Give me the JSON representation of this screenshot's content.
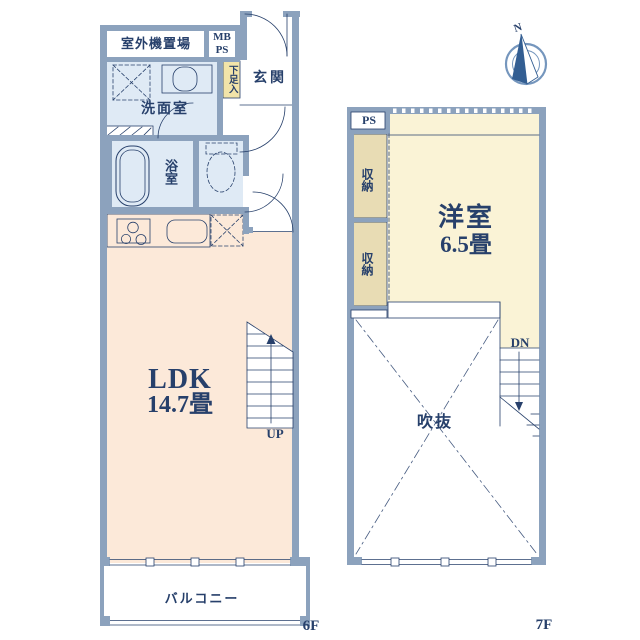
{
  "plan": {
    "floor_6f": {
      "floor_label": "6F",
      "outdoor_unit": "室外機置場",
      "meter_box": "MB",
      "pipe_shaft": "PS",
      "entrance": "玄関",
      "shoe_cabinet": "下足入",
      "washroom": "洗面室",
      "bathroom": "浴室",
      "ldk_name": "LDK",
      "ldk_size": "14.7畳",
      "stairs_up": "UP",
      "balcony": "バルコニー"
    },
    "floor_7f": {
      "floor_label": "7F",
      "pipe_shaft": "PS",
      "closet_upper": "収納",
      "closet_lower": "収納",
      "western_room_name": "洋室",
      "western_room_size": "6.5畳",
      "stairs_down": "DN",
      "atrium": "吹抜"
    },
    "compass_north": "N"
  },
  "colors": {
    "wall": "#8ca2bd",
    "line": "#27406b",
    "ldk_floor": "#fce9d9",
    "western_room_floor": "#faf3d6",
    "closet_fill": "#e8dcb4",
    "shoe_box_fill": "#f2e4a9",
    "wet_area_fill": "#dfeaf5",
    "compass": "#7596bd",
    "compass_dark": "#335e92"
  }
}
